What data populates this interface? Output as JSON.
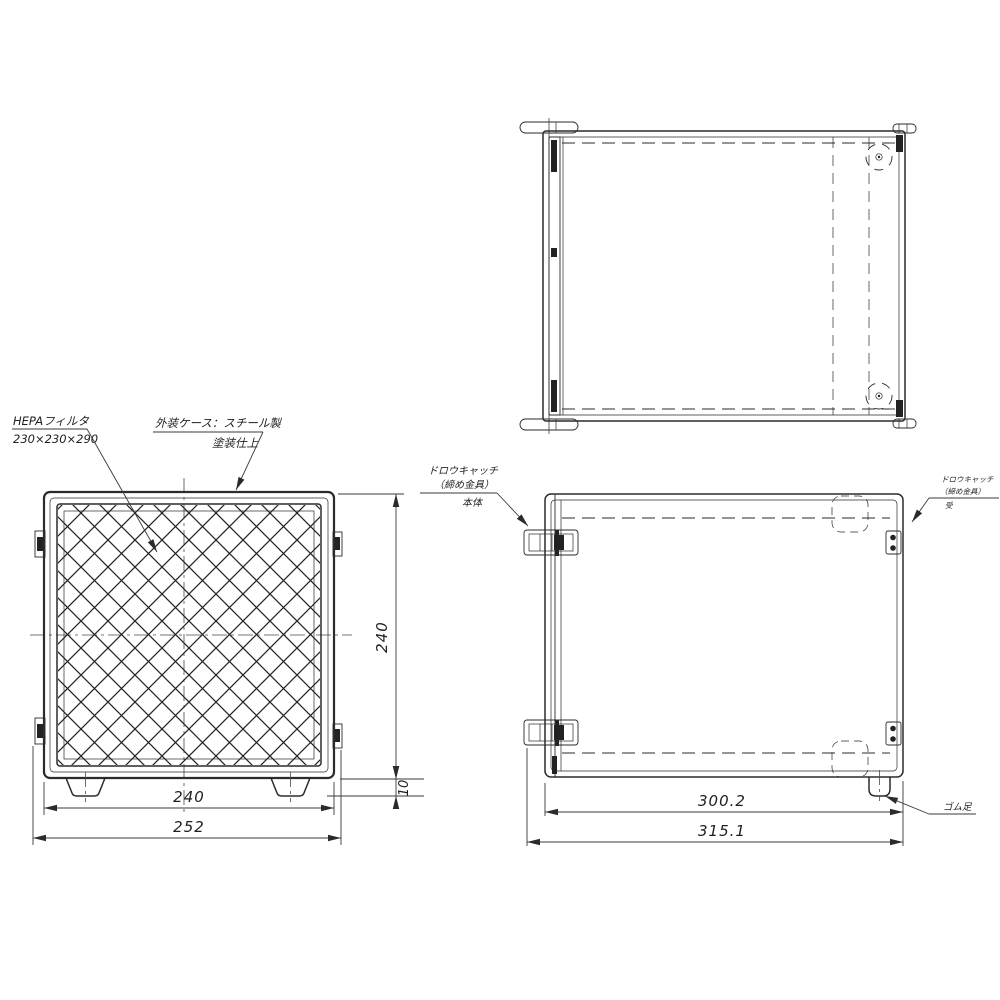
{
  "drawing": {
    "labels": {
      "hepa_filter": {
        "name": "HEPAフィルタ",
        "size": "230×230×290"
      },
      "outer_case": {
        "name": "外装ケース：スチール製",
        "finish": "塗装仕上"
      },
      "draw_catch_body": {
        "line1": "ドロウキャッチ",
        "line2": "（締め金具）",
        "line3": "本体"
      },
      "draw_catch_receiver": {
        "line1": "ドロウキャッチ",
        "line2": "（締め金具）",
        "line3": "受"
      },
      "rubber_foot": "ゴム足"
    },
    "dimensions": {
      "front_body_width": "240",
      "front_overall_width": "252",
      "front_body_height": "240",
      "foot_height": "10",
      "side_body_depth": "300.2",
      "side_overall_depth": "315.1"
    },
    "colors": {
      "line": "#2b2b2b",
      "background": "#ffffff"
    }
  }
}
